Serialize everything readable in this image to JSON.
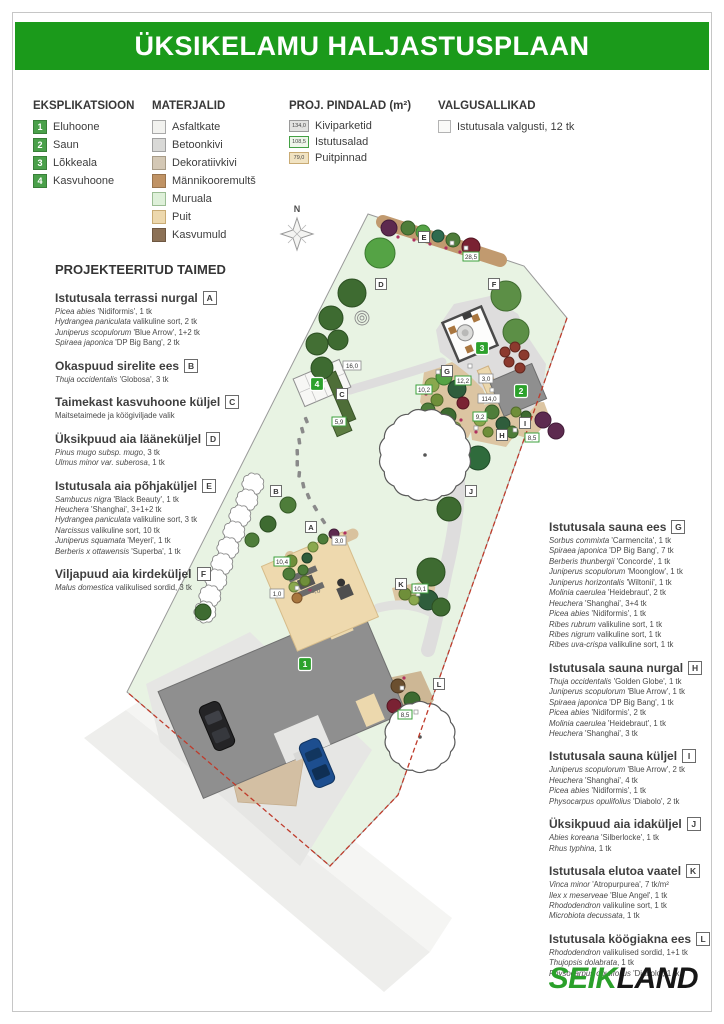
{
  "page": {
    "title": "ÜKSIKELAMU HALJASTUSPLAAN"
  },
  "colors": {
    "header_green": "#1b9a1b",
    "logo_green": "#2aa02a",
    "badge_green": "#2ca12c",
    "planting_label_border": "#3da03d",
    "boundary_red": "#bf3b2b"
  },
  "legend": {
    "explication": {
      "title": "EKSPLIKATSIOON",
      "items": [
        {
          "num": "1",
          "label": "Eluhoone"
        },
        {
          "num": "2",
          "label": "Saun"
        },
        {
          "num": "3",
          "label": "Lõkkeala"
        },
        {
          "num": "4",
          "label": "Kasvuhoone"
        }
      ]
    },
    "materials": {
      "title": "MATERJALID",
      "items": [
        {
          "label": "Asfaltkate",
          "color": "#f2f2ef",
          "border": "#a9a9a9"
        },
        {
          "label": "Betoonkivi",
          "color": "#d9d9d7",
          "border": "#a0a0a0"
        },
        {
          "label": "Dekoratiivkivi",
          "color": "#d4c8b5",
          "border": "#a89c88"
        },
        {
          "label": "Männikooremultš",
          "color": "#c09365",
          "border": "#99744e"
        },
        {
          "label": "Muruala",
          "color": "#def0d9",
          "border": "#9bbd94"
        },
        {
          "label": "Puit",
          "color": "#edd8ad",
          "border": "#c9ab74"
        },
        {
          "label": "Kasvumuld",
          "color": "#8c7156",
          "border": "#6e5741"
        }
      ]
    },
    "areas": {
      "title": "PROJ. PINDALAD (m²)",
      "items": [
        {
          "value": "134,0",
          "label": "Kiviparketid",
          "bg": "#e2e2e0",
          "border": "#9a9a9a"
        },
        {
          "value": "108,5",
          "label": "Istutusalad",
          "bg": "#eef6ea",
          "border": "#44a044"
        },
        {
          "value": "79,0",
          "label": "Puitpinnad",
          "bg": "#f1e3c2",
          "border": "#c9ab74"
        }
      ]
    },
    "lights": {
      "title": "VALGUSALLIKAD",
      "label": "Istutusala valgusti, 12 tk"
    }
  },
  "plants": {
    "title": "PROJEKTEERITUD TAIMED",
    "left": [
      {
        "heading": "Istutusala terrassi nurgal",
        "letter": "A",
        "items": [
          [
            "Picea abies",
            "'Nidiformis', 1 tk"
          ],
          [
            "Hydrangea paniculata",
            "valikuline sort, 2 tk"
          ],
          [
            "Juniperus scopulorum",
            "'Blue Arrow', 1+2 tk"
          ],
          [
            "Spiraea japonica",
            "'DP Big Bang', 2 tk"
          ]
        ]
      },
      {
        "heading": "Okaspuud sirelite ees",
        "letter": "B",
        "items": [
          [
            "Thuja occidentalis",
            "'Globosa', 3 tk"
          ]
        ]
      },
      {
        "heading": "Taimekast kasvuhoone küljel",
        "letter": "C",
        "items": [
          [
            "",
            "Maitsetaimede ja köögiviljade valik"
          ]
        ]
      },
      {
        "heading": "Üksikpuud aia lääneküljel",
        "letter": "D",
        "items": [
          [
            "Pinus mugo subsp. mugo",
            ", 3 tk"
          ],
          [
            "Ulmus minor var. suberosa",
            ", 1 tk"
          ]
        ]
      },
      {
        "heading": "Istutusala aia põhjaküljel",
        "letter": "E",
        "items": [
          [
            "Sambucus nigra",
            "'Black Beauty', 1 tk"
          ],
          [
            "Heuchera",
            "'Shanghai', 3+1+2 tk"
          ],
          [
            "Hydrangea paniculata",
            "valikuline sort, 3 tk"
          ],
          [
            "Narcissus",
            "valikuline sort, 10 tk"
          ],
          [
            "Juniperus squamata",
            "'Meyeri', 1 tk"
          ],
          [
            "Berberis x ottawensis",
            "'Superba', 1 tk"
          ]
        ]
      },
      {
        "heading": "Viljapuud aia kirdeküljel",
        "letter": "F",
        "items": [
          [
            "Malus domestica",
            "valikulised sordid, 3 tk"
          ]
        ]
      }
    ],
    "right": [
      {
        "heading": "Istutusala sauna ees",
        "letter": "G",
        "items": [
          [
            "Sorbus commixta",
            "'Carmencita', 1 tk"
          ],
          [
            "Spiraea japonica",
            "'DP Big Bang', 7 tk"
          ],
          [
            "Berberis thunbergii",
            "'Concorde', 1 tk"
          ],
          [
            "Juniperus scopulorum",
            "'Moonglow', 1 tk"
          ],
          [
            "Juniperus horizontalis",
            "'Wiltonii', 1 tk"
          ],
          [
            "Molinia caerulea",
            "'Heidebraut', 2 tk"
          ],
          [
            "Heuchera",
            "'Shanghai', 3+4 tk"
          ],
          [
            "Picea abies",
            "'Nidiformis', 1 tk"
          ],
          [
            "Ribes rubrum",
            "valikuline sort, 1 tk"
          ],
          [
            "Ribes nigrum",
            "valikuline sort, 1 tk"
          ],
          [
            "Ribes uva-crispa",
            "valikuline sort, 1 tk"
          ]
        ]
      },
      {
        "heading": "Istutusala sauna nurgal",
        "letter": "H",
        "items": [
          [
            "Thuja occidentalis",
            "'Golden Globe', 1 tk"
          ],
          [
            "Juniperus scopulorum",
            "'Blue Arrow', 1 tk"
          ],
          [
            "Spiraea japonica",
            "'DP Big Bang', 1 tk"
          ],
          [
            "Picea abies",
            "'Nidiformis', 2 tk"
          ],
          [
            "Molinia caerulea",
            "'Heidebraut', 1 tk"
          ],
          [
            "Heuchera",
            "'Shanghai', 3 tk"
          ]
        ]
      },
      {
        "heading": "Istutusala sauna küljel",
        "letter": "I",
        "items": [
          [
            "Juniperus scopulorum",
            "'Blue Arrow', 2 tk"
          ],
          [
            "Heuchera",
            "'Shanghai', 4 tk"
          ],
          [
            "Picea abies",
            "'Nidiformis', 1 tk"
          ],
          [
            "Physocarpus opulifolius",
            "'Diabolo', 2 tk"
          ]
        ]
      },
      {
        "heading": "Üksikpuud aia idaküljel",
        "letter": "J",
        "items": [
          [
            "Abies koreana",
            "'Silberlocke', 1 tk"
          ],
          [
            "Rhus typhina",
            ", 1 tk"
          ]
        ]
      },
      {
        "heading": "Istutusala elutoa vaatel",
        "letter": "K",
        "items": [
          [
            "Vinca minor",
            "'Atropurpurea', 7 tk/m²"
          ],
          [
            "Ilex x meserveae",
            "'Blue Angel', 1 tk"
          ],
          [
            "Rhododendron",
            "valikuline sort, 1 tk"
          ],
          [
            "Microbiota decussata",
            ", 1 tk"
          ]
        ]
      },
      {
        "heading": "Istutusala köögiakna ees",
        "letter": "L",
        "items": [
          [
            "Rhododendron",
            "valikulised sordid, 1+1 tk"
          ],
          [
            "Thujopsis dolabrata",
            ", 1 tk"
          ],
          [
            "Physocarpus opulifolius",
            "'Diabolo', 1 tk"
          ]
        ]
      }
    ]
  },
  "plan": {
    "north": "N",
    "badges": {
      "house": "1",
      "sauna": "2",
      "fire": "3",
      "greenhouse": "4"
    },
    "letters": {
      "a": "A",
      "b": "B",
      "c": "C",
      "d": "D",
      "e": "E",
      "f": "F",
      "g": "G",
      "h": "H",
      "i": "I",
      "j": "J",
      "k": "K",
      "l": "L"
    },
    "areas": {
      "greenhouse": "16,0",
      "planter": "5,9",
      "bed_north": "28,5",
      "bed_g_left": "10,2",
      "bed_g_right": "12,2",
      "wood_sauna": "3,0",
      "paving_main": "114,0",
      "bed_h": "9,2",
      "bed_i": "8,5",
      "terrace_bed": "10,4",
      "paving_small": "1,0",
      "wood_terrace": "3,0",
      "terrace": "76,0",
      "bed_k": "10,1",
      "bed_l": "8,5"
    }
  },
  "footer": {
    "logo_first": "SEIK",
    "logo_second": "LAND"
  }
}
